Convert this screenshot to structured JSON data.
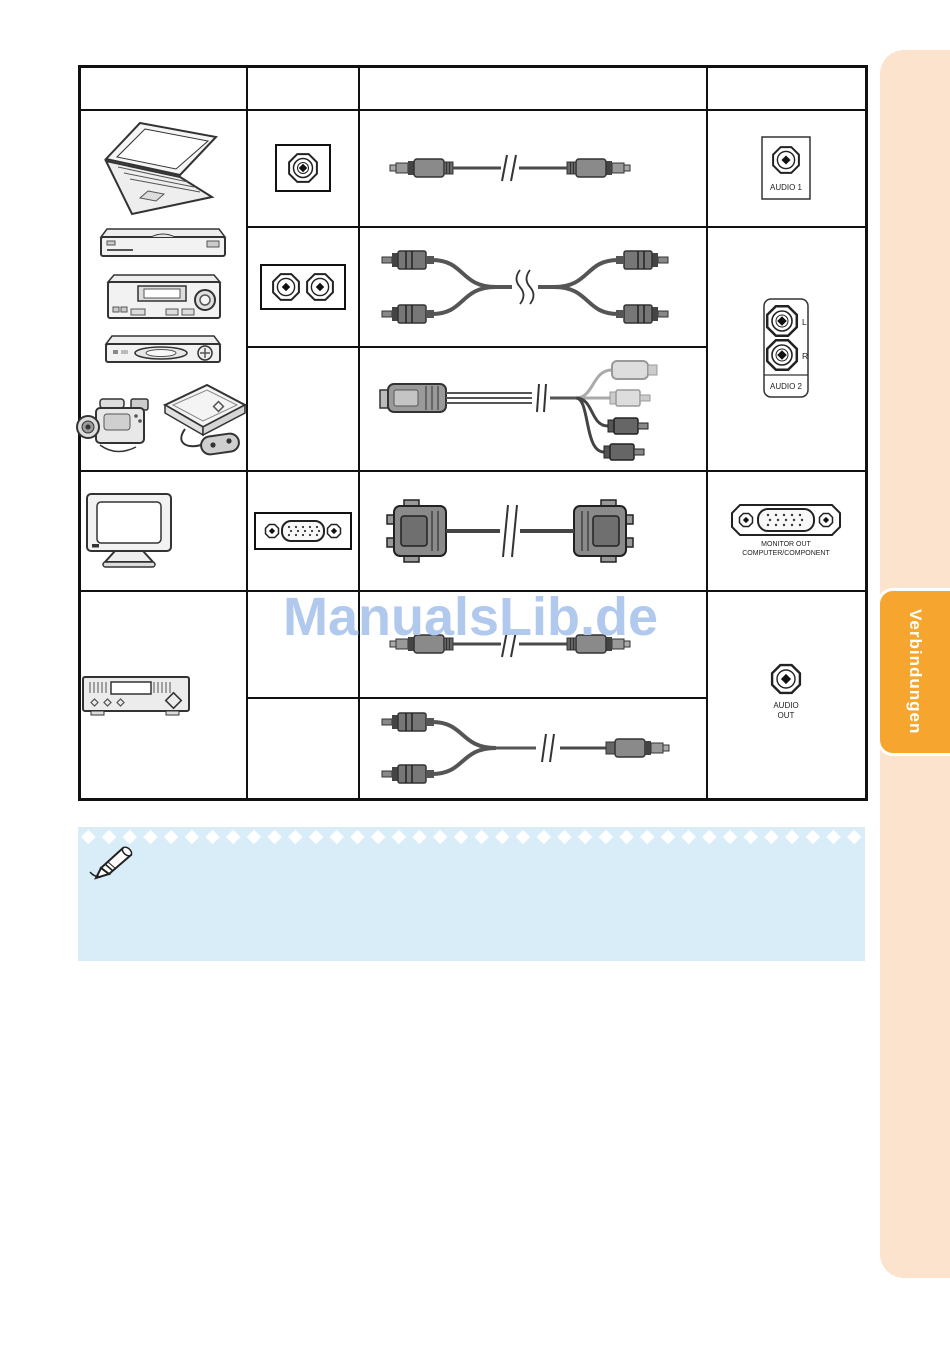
{
  "watermark": {
    "text": "ManualsLib.de",
    "color": "#b2c9ee"
  },
  "sidebar": {
    "tab_label": "Verbindungen",
    "tab_color": "#f6a62e",
    "panel_color": "#fbe3cd"
  },
  "note": {
    "bg_color": "#d9edf8"
  },
  "table": {
    "headers": {
      "device": "",
      "terminal": "",
      "cable": "",
      "port": ""
    },
    "ports": {
      "audio1_label": "AUDIO 1",
      "audio2_label": "AUDIO 2",
      "audio2_left": "L",
      "audio2_right": "R",
      "monitor_out_line1": "MONITOR OUT",
      "monitor_out_line2": "COMPUTER/COMPONENT",
      "audio_out_line1": "AUDIO",
      "audio_out_line2": "OUT"
    },
    "devices": [
      "laptop",
      "dvd-player",
      "vcr",
      "set-top-box",
      "camcorder",
      "game-console",
      "monitor",
      "amplifier"
    ],
    "cables": [
      "stereo-minijack-cable",
      "rca-audio-cable",
      "camcorder-av-cable",
      "vga-cable",
      "stereo-minijack-cable",
      "rca-to-minijack-cable"
    ]
  }
}
